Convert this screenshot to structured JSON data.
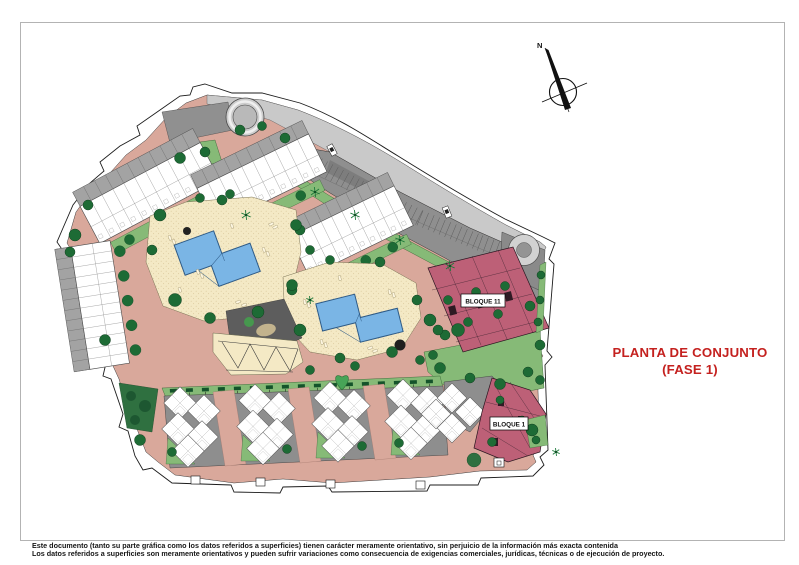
{
  "document": {
    "north_label": "N",
    "title_line1": "PLANTA DE CONJUNTO",
    "title_line2": "(FASE 1)",
    "blocks": {
      "bloque11": "BLOQUE 11",
      "bloque1": "BLOQUE 1"
    },
    "disclaimer_line1": "Este documento (tanto su parte gráfica como los datos referidos a superficies) tienen carácter meramente orientativo, sin perjuicio de la información más exacta contenida",
    "disclaimer_line2": "Los datos referidos a superficies son meramente orientativos y pueden sufrir variaciones como consecuencia de exigencias comerciales, jurídicas, técnicas o de ejecución de proyecto."
  },
  "colors": {
    "accent": "#c4211f",
    "block": "#bd6077",
    "pool": "#7ab5e5",
    "deck": "#f4e9c5",
    "salmon": "#d9a89b",
    "green1": "#9bc98b",
    "green2": "#86ba77",
    "tree": "#1d6b35",
    "road": "#c9c9c9",
    "parking": "#8f8f8f",
    "dark_zone": "#5d5d5d",
    "sheet_border": "#b3b3b3"
  }
}
